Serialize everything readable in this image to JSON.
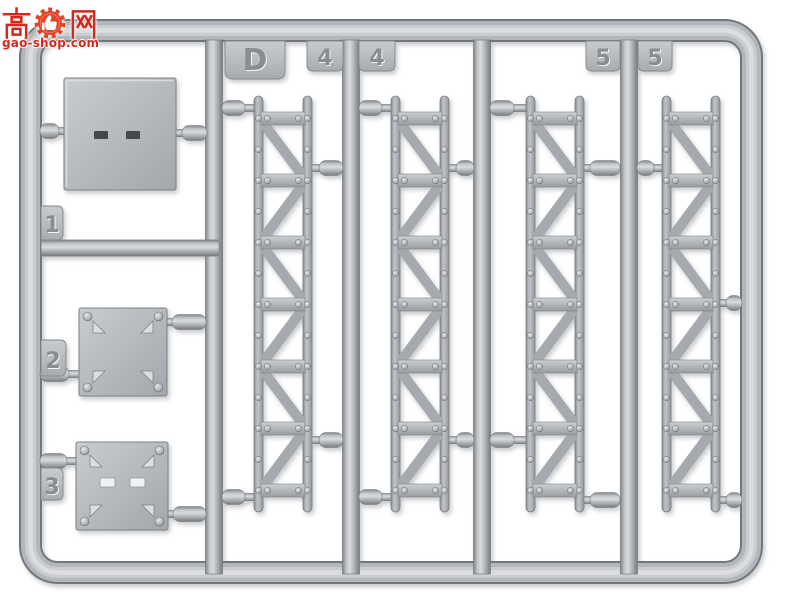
{
  "watermark": {
    "char_left": "高",
    "char_right": "网",
    "domain": "gao-shop.com",
    "color": "#d5281c",
    "icon": "gear-thumbs-up-icon"
  },
  "sprue": {
    "tabs": {
      "gate_letter": "D",
      "four_left": "4",
      "four_right": "4",
      "five_left": "5",
      "five_right": "5",
      "one": "1",
      "two": "2",
      "three": "3"
    },
    "colors": {
      "plastic_base": "#b2b6ba",
      "plastic_highlight": "#d8dadc",
      "plastic_shadow": "#74787c",
      "background": "#ffffff"
    }
  }
}
